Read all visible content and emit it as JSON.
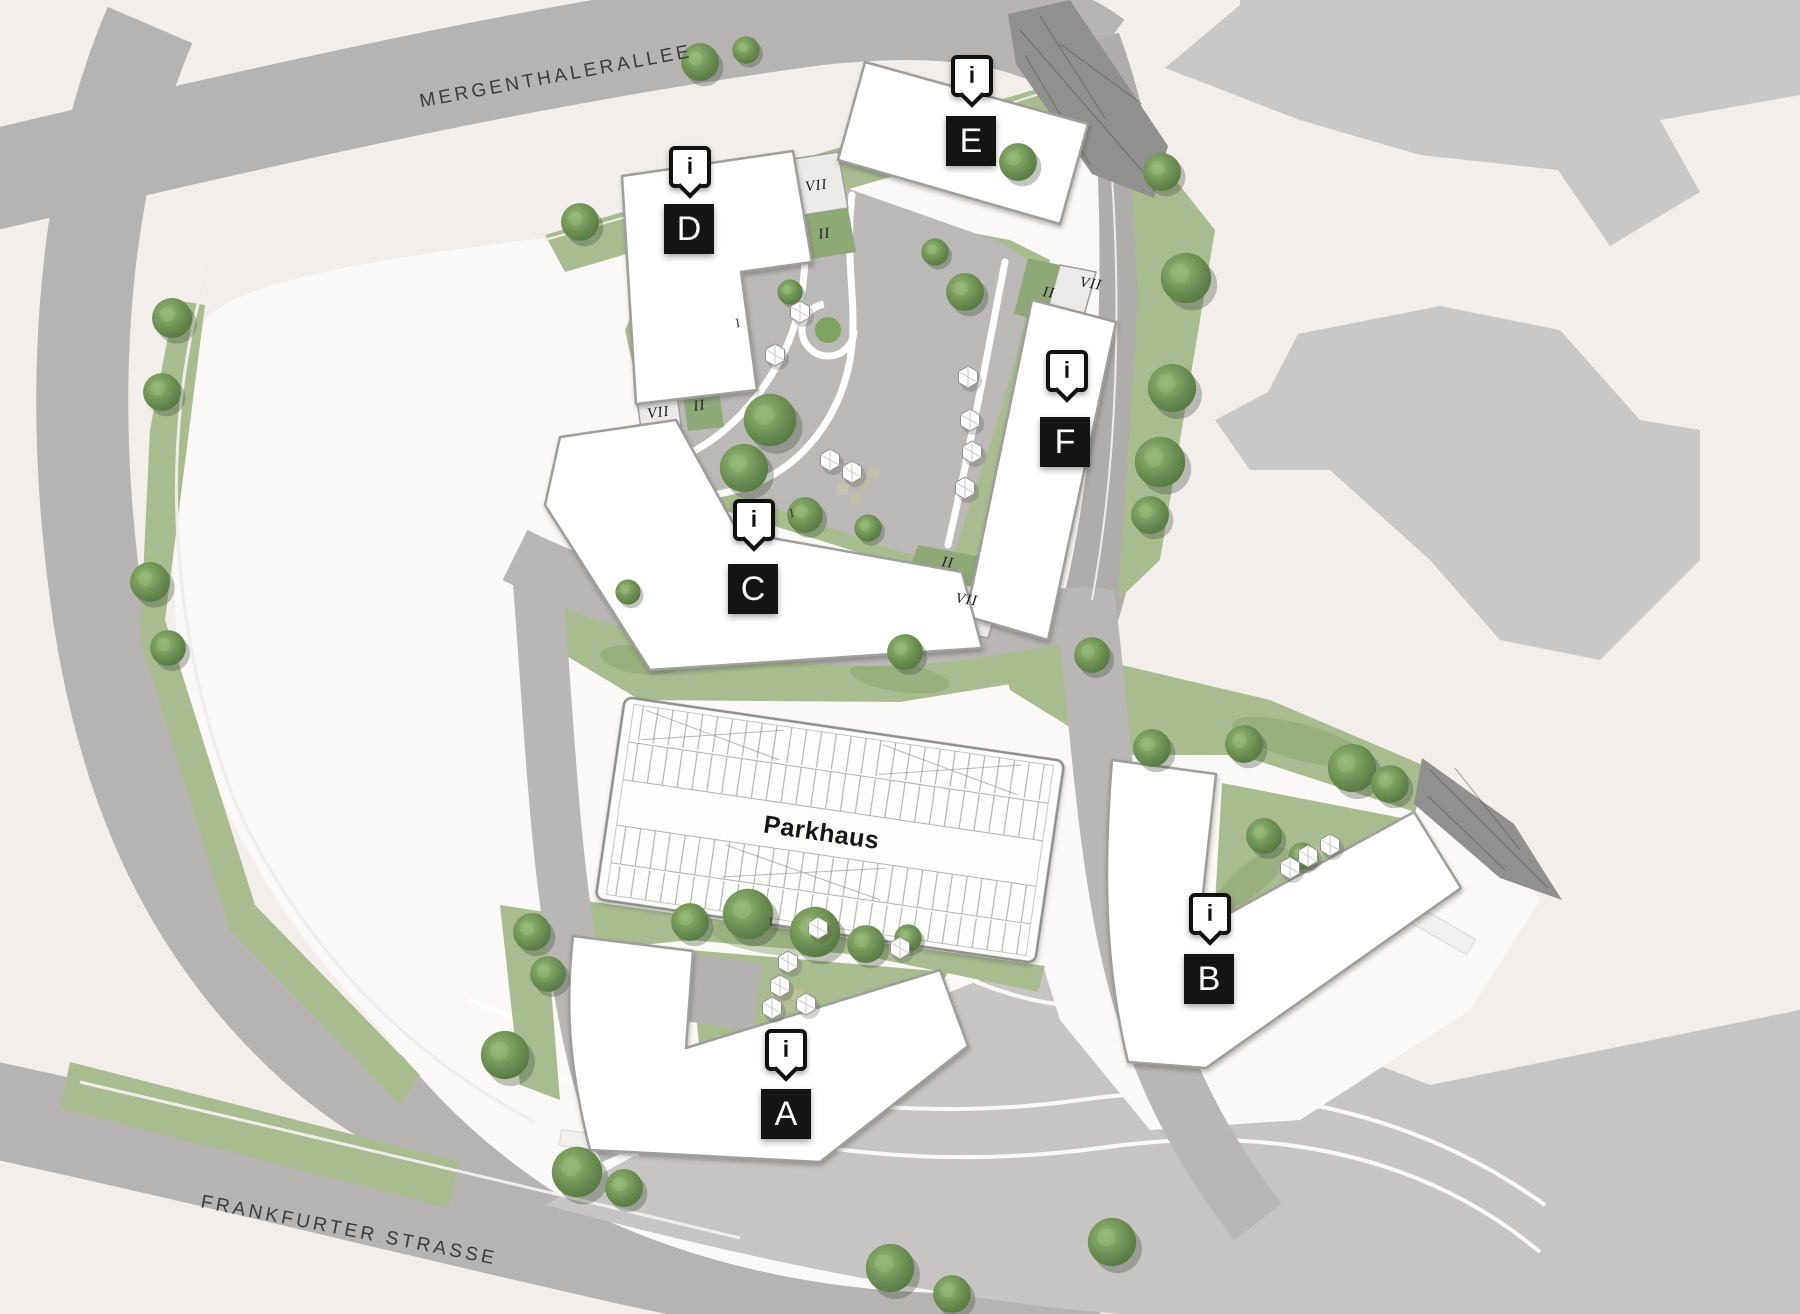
{
  "streets": {
    "north": "MERGENTHALERALLEE",
    "south": "FRANKFURTER STRASSE"
  },
  "parkhaus": {
    "label": "Parkhaus"
  },
  "markers": {
    "info_glyph": "i",
    "items": [
      {
        "id": "a",
        "letter": "A"
      },
      {
        "id": "b",
        "letter": "B"
      },
      {
        "id": "c",
        "letter": "C"
      },
      {
        "id": "d",
        "letter": "D"
      },
      {
        "id": "e",
        "letter": "E"
      },
      {
        "id": "f",
        "letter": "F"
      }
    ]
  },
  "levels": {
    "de_band": "VII",
    "de_green": "II",
    "dc_band": "VII",
    "dc_green": "II",
    "ef_green": "II",
    "ef_band": "VII",
    "cf_green": "II",
    "cf_band": "VII",
    "ground_marks": [
      "I",
      "I",
      "I"
    ]
  },
  "colors": {
    "background": "#f1eeec",
    "road": "#b5b4b2",
    "road_vertical": "#aeadab",
    "road_interior": "#b8b7b5",
    "site": "#faf9f7",
    "expanse": "#c6c5c3",
    "neighbor": "#c9c8c6",
    "neighbor_dark": "#b7b6b4",
    "lawn": "#a9bc90",
    "lawn_dark": "#86a06b",
    "plaza": "#bab9b7",
    "connector_green": "#8fa878",
    "connector_band": "#eceae8",
    "building": "#ffffff",
    "building_outline": "#9e9e9c",
    "ramp": "#90908e",
    "marker_bg": "#141414",
    "marker_fg": "#ffffff",
    "label_text": "#3b3b3b"
  }
}
